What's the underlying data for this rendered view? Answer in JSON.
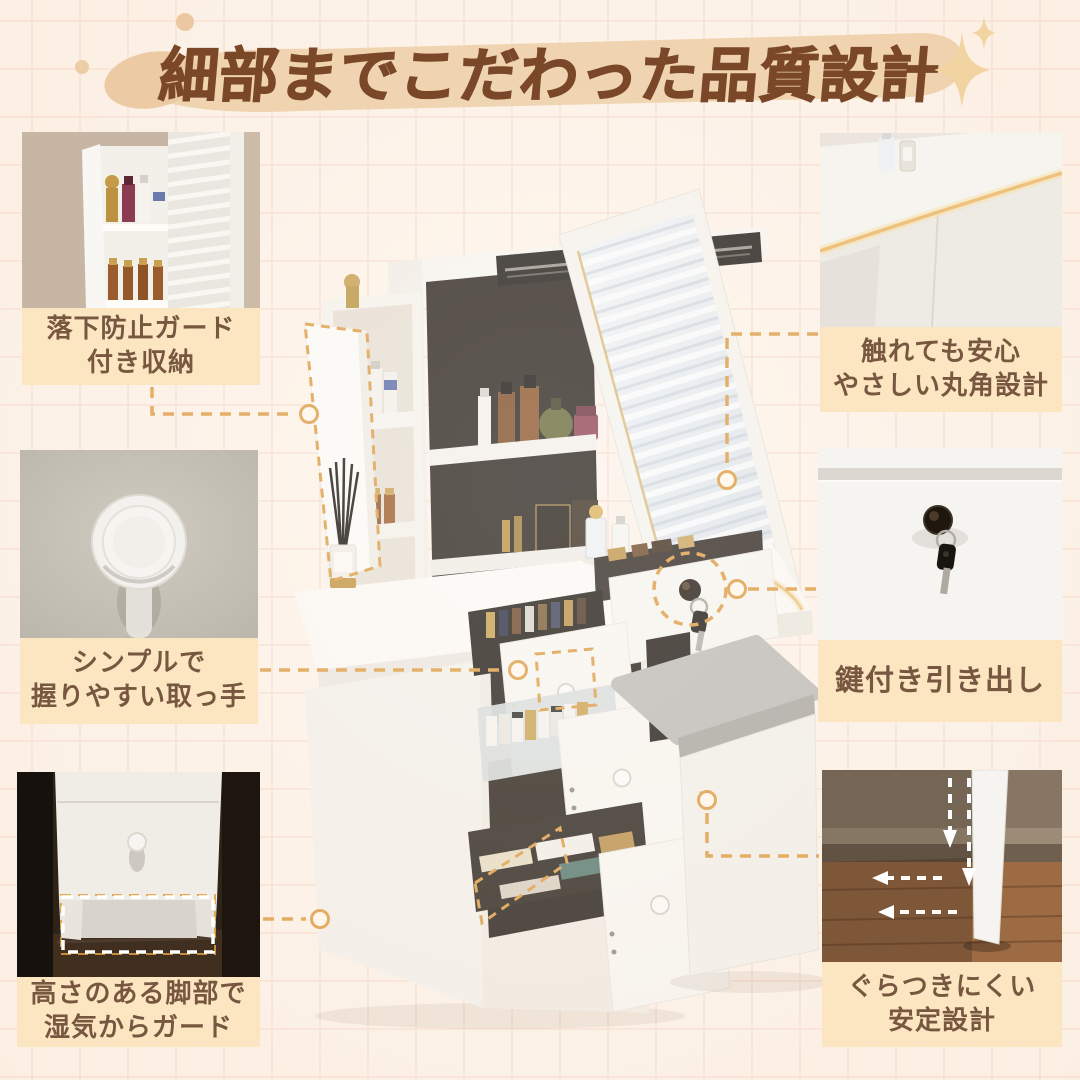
{
  "header": {
    "title": "細部までこだわった品質設計"
  },
  "callouts": {
    "fall_guard": {
      "line1": "落下防止ガード",
      "line2": "付き収納"
    },
    "handle": {
      "line1": "シンプルで",
      "line2": "握りやすい取っ手"
    },
    "legs": {
      "line1": "高さのある脚部で",
      "line2": "湿気からガード"
    },
    "corner": {
      "line1": "触れても安心",
      "line2": "やさしい丸角設計"
    },
    "lock": {
      "line1": "鍵付き引き出し"
    },
    "stable": {
      "line1": "ぐらつきにくい",
      "line2": "安定設計"
    }
  },
  "style": {
    "background": "#fdf3e9",
    "grid_line": "#f7d6c4",
    "title_color": "#7a4828",
    "brush_color": "#edcda3",
    "label_background": "#fce6c2",
    "label_text": "#775740",
    "connector_accent": "#dd9c43",
    "sparkle_color": "#f2d4a3"
  }
}
